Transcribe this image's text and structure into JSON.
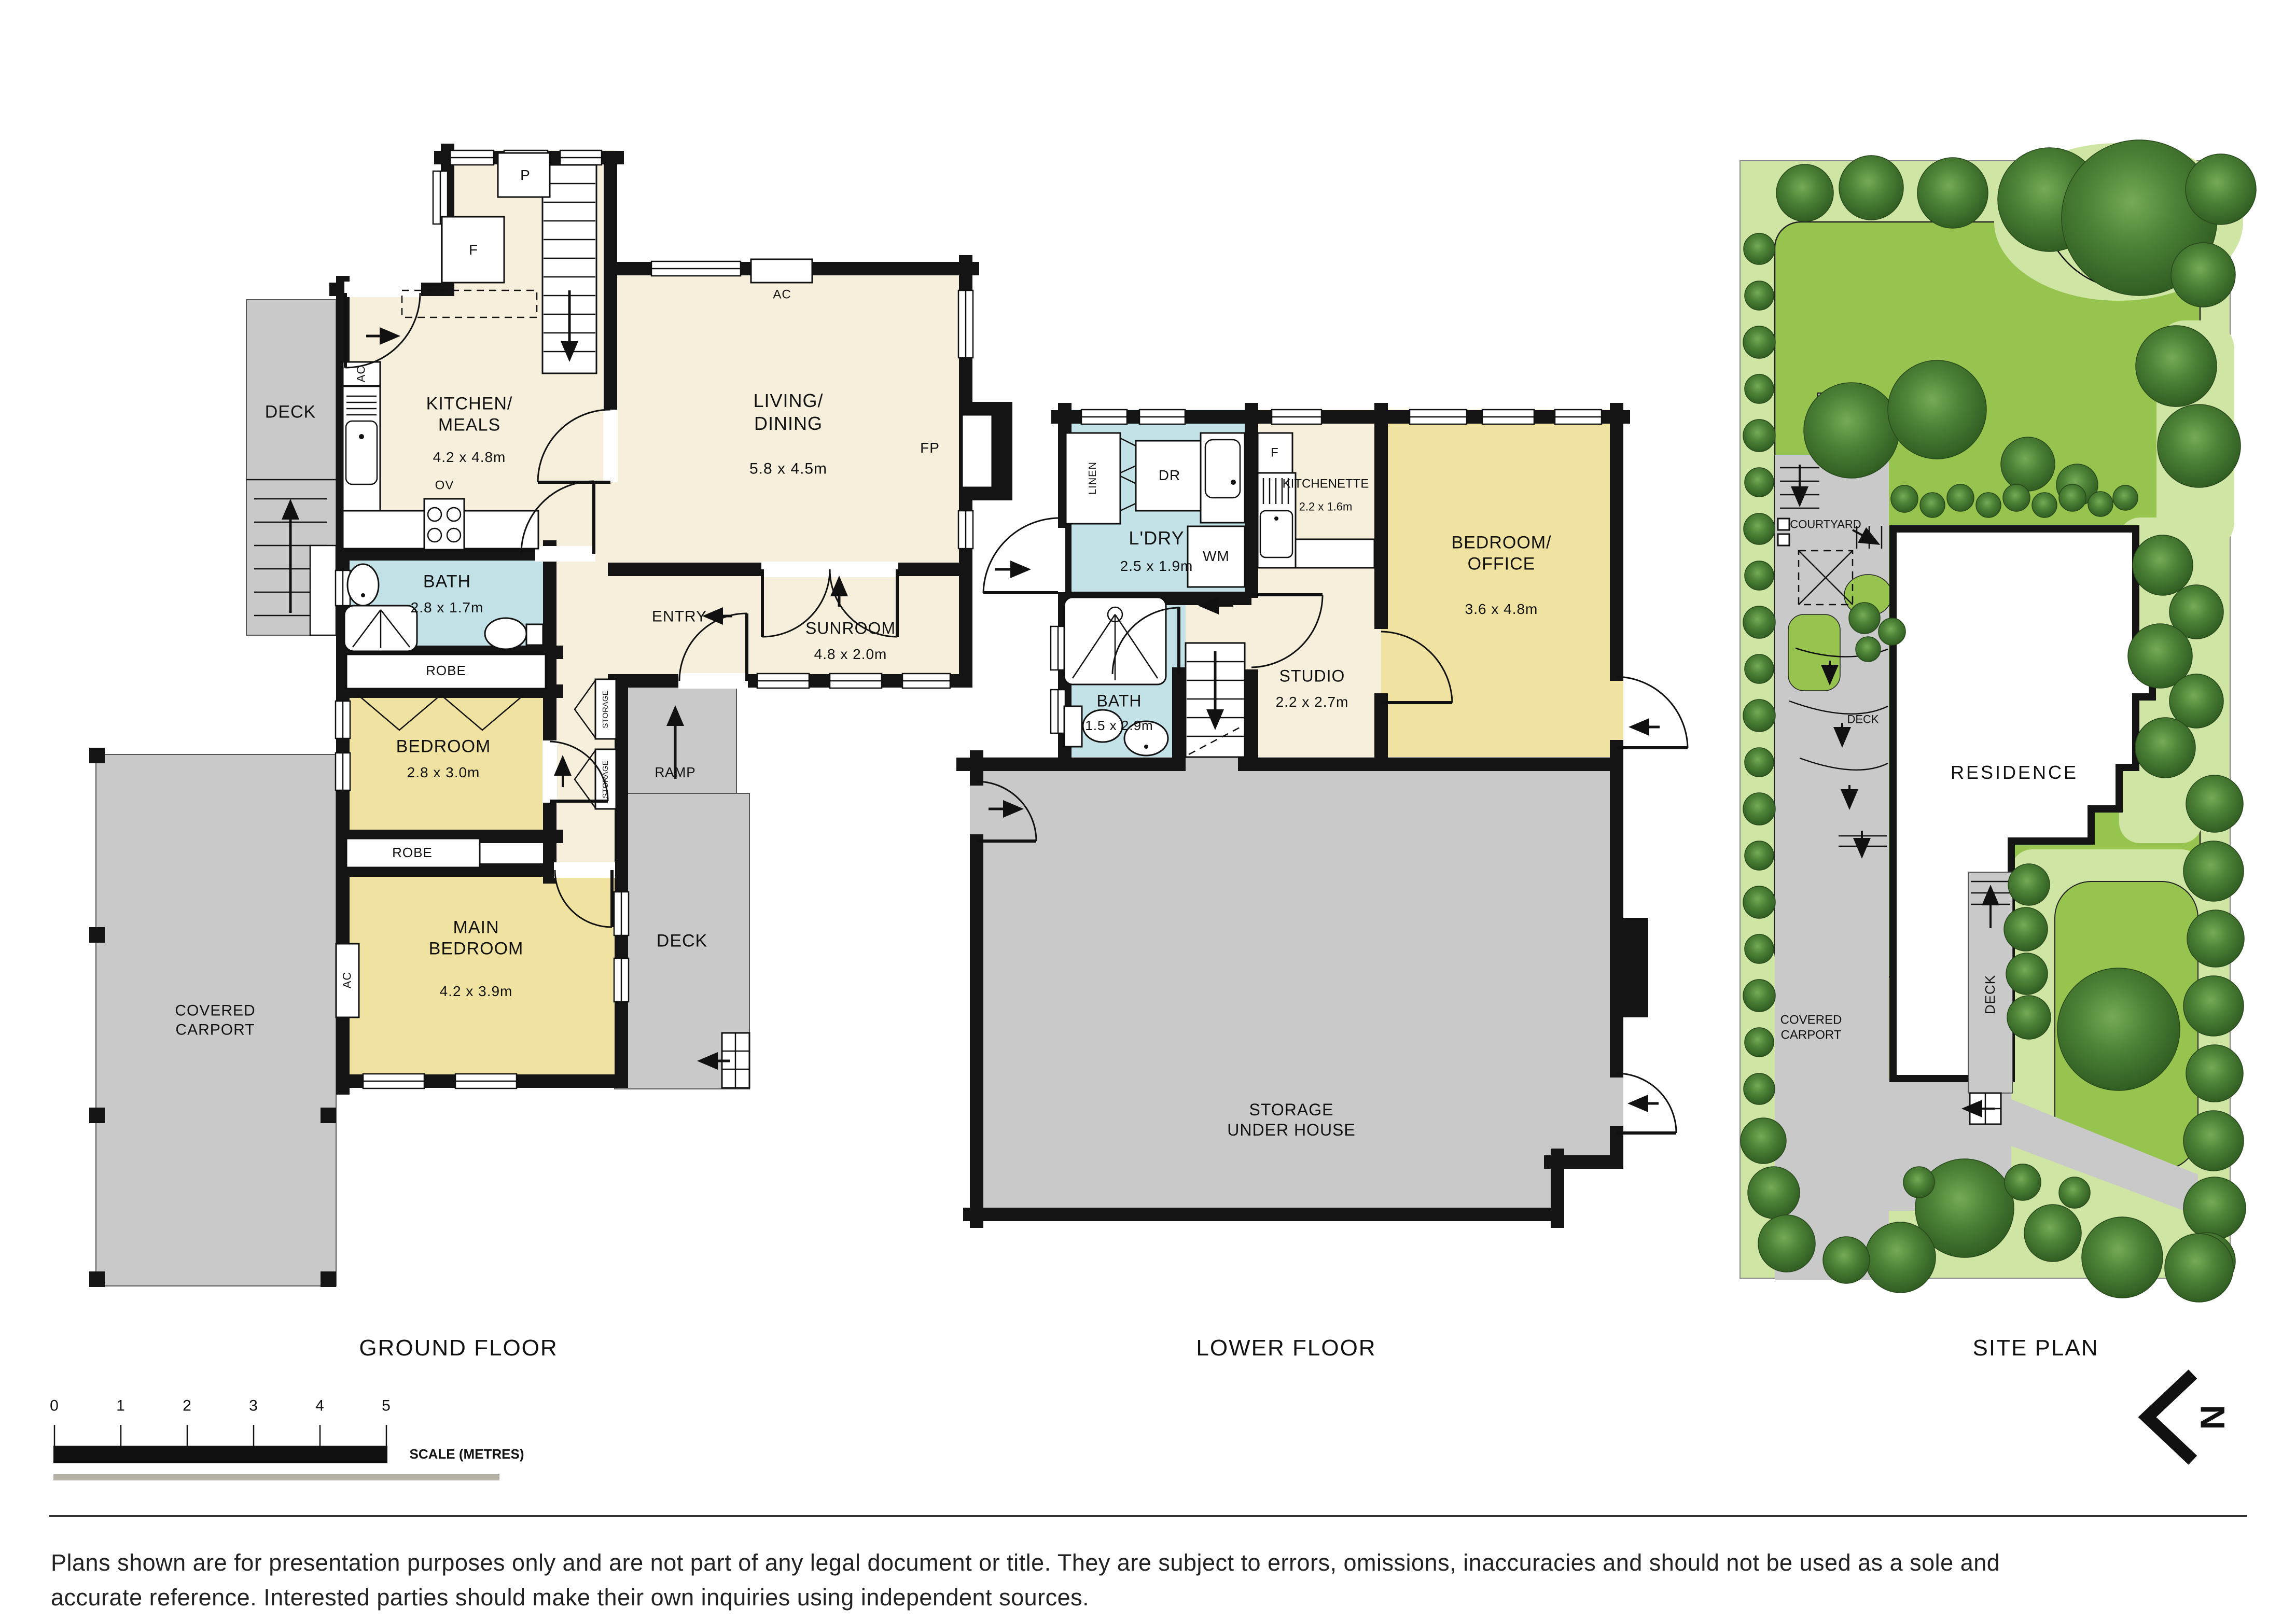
{
  "ground": {
    "title": "GROUND FLOOR",
    "deck_top": "DECK",
    "deck_right": "DECK",
    "kitchen": {
      "name": "KITCHEN/\nMEALS",
      "dims": "4.2 x 4.8m"
    },
    "living": {
      "name": "LIVING/\nDINING",
      "dims": "5.8 x 4.5m"
    },
    "bath": {
      "name": "BATH",
      "dims": "2.8 x 1.7m"
    },
    "bedroom": {
      "name": "BEDROOM",
      "dims": "2.8 x 3.0m"
    },
    "main_bedroom": {
      "name": "MAIN\nBEDROOM",
      "dims": "4.2 x 3.9m"
    },
    "sunroom": {
      "name": "SUNROOM",
      "dims": "4.8 x 2.0m"
    },
    "entry": "ENTRY",
    "ramp": "RAMP",
    "robe1": "ROBE",
    "robe2": "ROBE",
    "carport": "COVERED\nCARPORT",
    "fixtures": {
      "pantry": "P",
      "fridge": "F",
      "oven": "OV",
      "ac1": "AC",
      "ac2": "AC",
      "ac3": "AC",
      "fireplace": "FP",
      "storage1": "STORAGE",
      "storage2": "STORAGE"
    }
  },
  "lower": {
    "title": "LOWER FLOOR",
    "laundry": {
      "name": "L'DRY",
      "dims": "2.5 x 1.9m"
    },
    "bath": {
      "name": "BATH",
      "dims": "1.5 x 2.9m"
    },
    "kitchenette": {
      "name": "KITCHENETTE",
      "dims": "2.2 x 1.6m"
    },
    "studio": {
      "name": "STUDIO",
      "dims": "2.2 x 2.7m"
    },
    "bed_office": {
      "name": "BEDROOM/\nOFFICE",
      "dims": "3.6 x 4.8m"
    },
    "storage": {
      "name": "STORAGE\nUNDER HOUSE"
    },
    "fixtures": {
      "linen": "LINEN",
      "dryer": "DR",
      "washer": "WM",
      "fridge": "F"
    }
  },
  "site": {
    "title": "SITE PLAN",
    "residence": "RESIDENCE",
    "courtyard": "COURTYARD",
    "deck1": "DECK",
    "deck2": "DECK",
    "carport": "COVERED\nCARPORT"
  },
  "scalebar": {
    "ticks": [
      "0",
      "1",
      "2",
      "3",
      "4",
      "5"
    ],
    "label": "SCALE (METRES)"
  },
  "north": {
    "letter": "N"
  },
  "disclaimer": {
    "line1": "Plans shown are for presentation purposes only and are not part of any legal document or title. They are subject to errors, omissions, inaccuracies and should not be used as a sole and",
    "line2": "accurate reference. Interested parties should make their own inquiries using independent sources."
  },
  "colors": {
    "floor_beige": "#F6EFDC",
    "room_yellow": "#F0E3A1",
    "bath_blue": "#C3E2E8",
    "outdoor_gray": "#C9C9C9",
    "wall_black": "#141414",
    "site_light_green": "#CFE5A3",
    "site_lawn_green": "#96C44F",
    "tree_green": "#3E7A2E"
  }
}
